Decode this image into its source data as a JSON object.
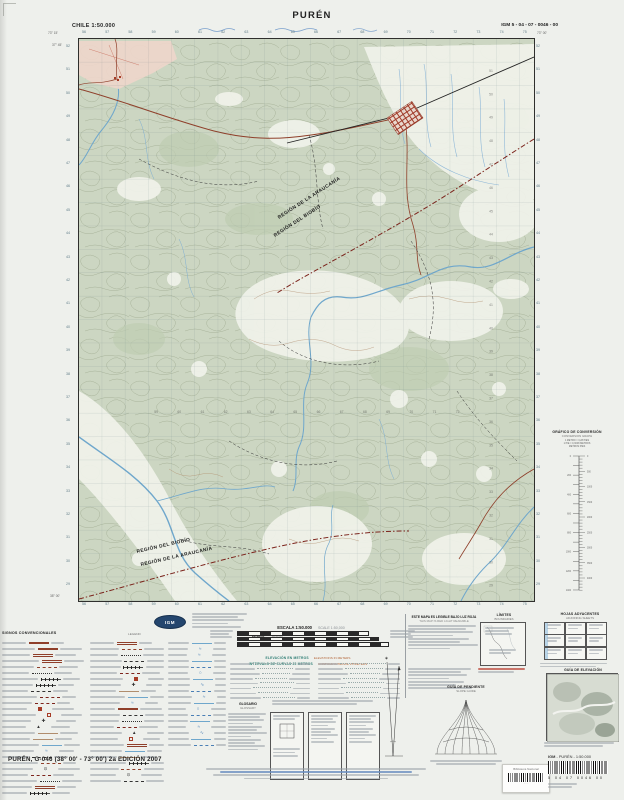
{
  "header": {
    "left": "CHILE 1:50.000",
    "title": "PURÉN",
    "right": "IGM 5 - 04 - 07 - 0046 - 00"
  },
  "map": {
    "regions_upper": [
      "REGIÓN DE LA ARAUCANÍA",
      "REGIÓN DEL BIOBÍO"
    ],
    "regions_lower": [
      "REGIÓN DEL BIOBÍO",
      "REGIÓN DE LA ARAUCANÍA"
    ],
    "corners": {
      "top_left_lon": "73° 15'",
      "top_right_lon": "73° 00'",
      "top_left_lat": "37° 45'",
      "bottom_left_lat": "38° 00'"
    },
    "grid": {
      "eastings": [
        "56",
        "57",
        "58",
        "59",
        "60",
        "61",
        "62",
        "63",
        "64",
        "65",
        "66",
        "67",
        "68",
        "69",
        "70",
        "71",
        "72",
        "73",
        "74",
        "75"
      ],
      "northings": [
        "52",
        "51",
        "50",
        "49",
        "48",
        "47",
        "46",
        "45",
        "44",
        "43",
        "42",
        "41",
        "40",
        "39",
        "38",
        "37",
        "36",
        "35",
        "34",
        "33",
        "32",
        "31",
        "30",
        "29"
      ]
    }
  },
  "right_margin": {
    "conversion_title": "GRÁFICO DE CONVERSIÓN",
    "conversion_title_en": "CONVERSION GRAPH",
    "conversion_rows": [
      "1 METRO = 3,28 PIES",
      "1 PIE = 0,3048 METROS",
      "METROS        PIES"
    ]
  },
  "scale_block": {
    "title_es": "ESCALA 1:50.000",
    "title_en": "SCALE 1:50,000",
    "metros": "METROS",
    "meters": "METERS",
    "elev_es": "ELEVACIÓN EN METROS",
    "elev_en": "ELEVATIONS IN METERS",
    "interval_es": "INTERVALO DE CURVAS 25 METROS",
    "interval_en": "CONTOUR INTERVAL 25 METERS"
  },
  "legend": {
    "title": "SIGNOS CONVENCIONALES",
    "title_en": "LEGEND",
    "col1": [
      "road-paved",
      "road-paved",
      "road-2",
      "road-2",
      "road-dash",
      "trail",
      "rail",
      "rail",
      "dash-black",
      "boundary",
      "boundary",
      "building",
      "building-o",
      "g:✚:#333",
      "g:▲:#333",
      "contour",
      "contour",
      "stream",
      "g:≈:#4a7fb5",
      "dash-black",
      "road-dash",
      "g:⊙:#333",
      "boundary",
      "trail",
      "road-2",
      "rail"
    ],
    "col2": [
      "road-2",
      "road-dash",
      "trail",
      "dash-black",
      "rail",
      "boundary",
      "building",
      "g:✚:#333",
      "contour",
      "stream",
      "g:≈:#4a7fb5",
      "road-paved",
      "dash-black",
      "trail",
      "boundary",
      "g:▲:#333",
      "building-o",
      "road-2",
      "stream",
      "contour",
      "rail",
      "road-dash",
      "g:⊙:#333",
      "dash-black"
    ],
    "col3": [
      "stream",
      "g:≈:#4a7fb5",
      "g:≈:#4a7fb5",
      "stream",
      "canal",
      "g:○:#4a7fb5",
      "stream",
      "g:∿:#4a7fb5",
      "canal",
      "g:≈:#4a7fb5",
      "stream",
      "g:○:#4a7fb5",
      "canal",
      "stream",
      "g:≈:#4a7fb5",
      "g:∿:#4a7fb5",
      "stream",
      "canal"
    ]
  },
  "glossary": {
    "es": "GLOSARIO",
    "en": "GLOSSARY"
  },
  "red_light": {
    "es": "ESTE MAPA ES LEGIBLE BAJO LUZ ROJA",
    "en": "THIS MAP IS RED LIGHT READABLE"
  },
  "boxes": {
    "limites": "LÍMITES",
    "limites_en": "BOUNDARIES",
    "hojas": "HOJAS ADYACENTES",
    "hojas_en": "ADJOINING SHEETS",
    "guia_pendiente": "GUÍA DE PENDIENTE",
    "guia_pendiente_en": "SLOPE GUIDE",
    "guia_elevacion": "GUÍA DE ELEVACIÓN"
  },
  "logo": "IGM",
  "footer": {
    "sheet_title": "PURÉN, G-046 (38° 00' - 73° 00') 2a EDICIÓN 2007",
    "igm_label_prefix": "IGM",
    "igm_label_rest": " - PURÉN - 1:50.000",
    "code_digits": "5    04    07    0046    00",
    "sticker": "Biblioteca Nacional"
  }
}
